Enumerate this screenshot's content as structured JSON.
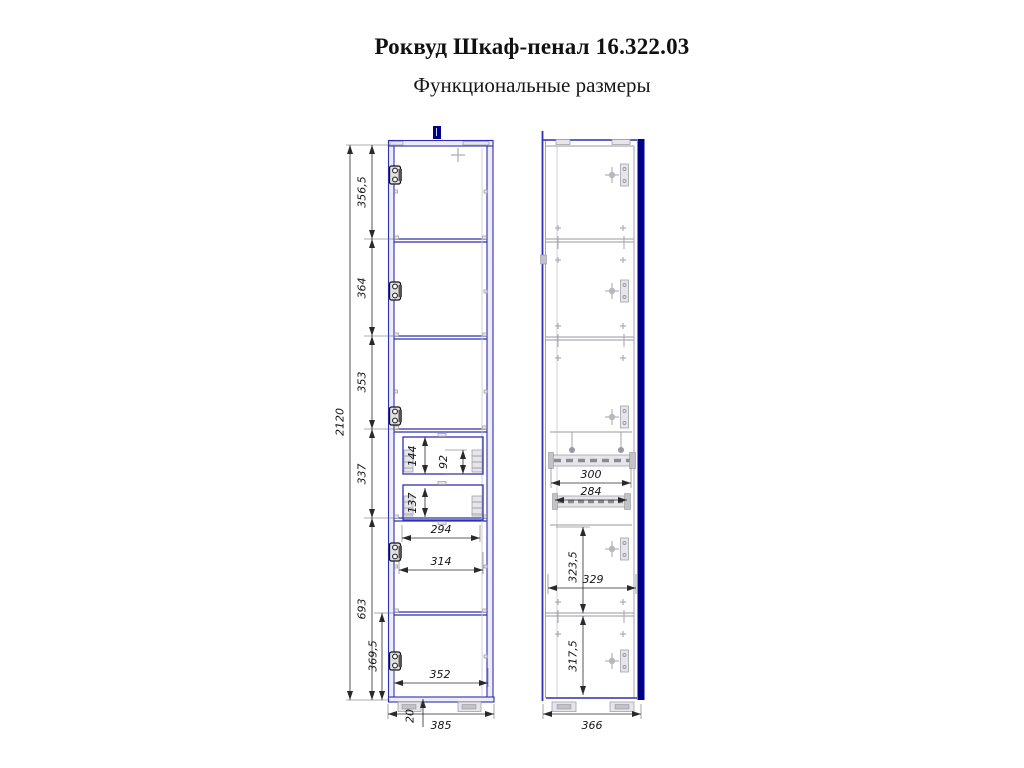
{
  "title": "Роквуд Шкаф-пенал 16.322.03",
  "subtitle": "Функциональные размеры",
  "colors": {
    "frame_blue": "#2f2fb2",
    "door_navy": "#00008b",
    "dimension_black": "#2a2a2a"
  },
  "front_view": {
    "overall_height": "2120",
    "top_section_height": "356,5",
    "second_section_height": "364",
    "third_section_height": "353",
    "drawer_section_height": "337",
    "lower_section_height": "693",
    "bottom_compartment_height": "369,5",
    "upper_drawer_height": "144",
    "upper_drawer_box_height": "92",
    "lower_drawer_height": "137",
    "drawer_opening_width": "294",
    "drawer_front_width": "314",
    "bottom_opening_width": "352",
    "bottom_panel_thickness": "20",
    "overall_width": "385"
  },
  "side_view": {
    "upper_slide_length": "300",
    "lower_slide_length": "284",
    "middle_compartment_height": "323,5",
    "shelf_depth": "329",
    "bottom_compartment_height": "317,5",
    "overall_depth": "366"
  }
}
